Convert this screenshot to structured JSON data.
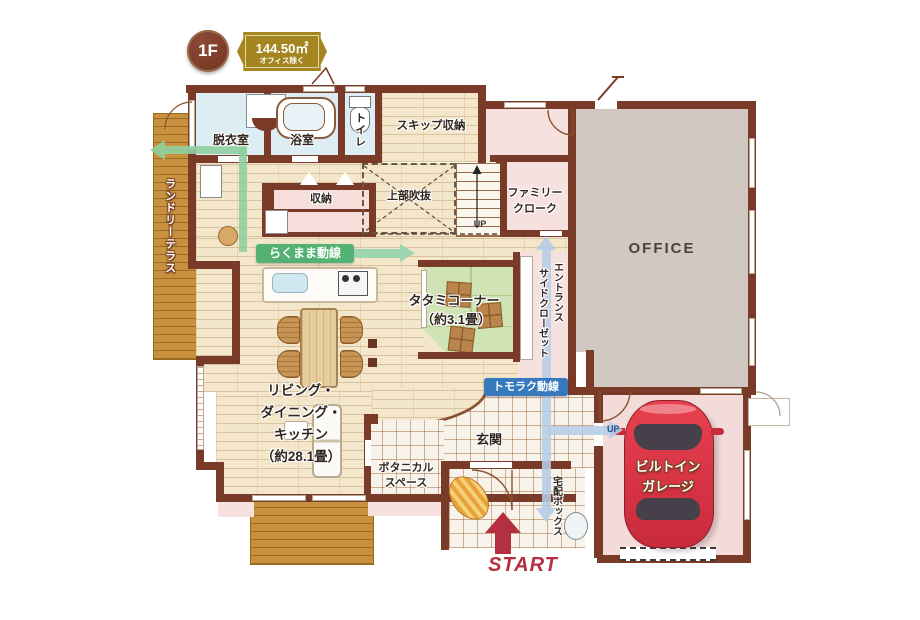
{
  "badges": {
    "floor": "1F",
    "area": "144.50㎡",
    "area_note": "オフィス除く"
  },
  "rooms": {
    "laundry_terrace": "ランドリーテラス",
    "dressing": "脱衣室",
    "bath": "浴室",
    "toilet": "トイレ",
    "skip_storage": "スキップ収納",
    "void_above": "上部吹抜",
    "storage": "収納",
    "stairs_up": "UP",
    "family_cloak_l1": "ファミリー",
    "family_cloak_l2": "クローク",
    "office": "OFFICE",
    "tatami_l1": "タタミコーナー",
    "tatami_l2": "（約3.1畳）",
    "entrance_closet_col1": "エントランス",
    "entrance_closet_col2": "サイドクローゼット",
    "ldk_l1": "リビング・",
    "ldk_l2": "ダイニング・",
    "ldk_l3": "キッチン",
    "ldk_l4": "（約28.1畳）",
    "botanical_l1": "ボタニカル",
    "botanical_l2": "スペース",
    "entrance": "玄関",
    "delivery_box": "宅配ボックス",
    "garage_l1": "ビルトイン",
    "garage_l2": "ガレージ",
    "garage_up": "UP",
    "start": "START"
  },
  "flows": {
    "green_label": "らくまま動線",
    "blue_label": "トモラク動線"
  },
  "colors": {
    "wall": "#7a3a28",
    "wood_floor": "#f3e6ca",
    "deck": "#c8913d",
    "water_floor": "#dcedf4",
    "pink_floor": "#f7e1de",
    "office_floor": "#d0c8c1",
    "tatami": "#d0e3b4",
    "flow_green": "#53b173",
    "flow_blue": "#3679bd",
    "start_red": "#b43040",
    "car_red": "#d93644",
    "badge_gold": "#a5851f",
    "badge_brown": "#7c4030"
  }
}
